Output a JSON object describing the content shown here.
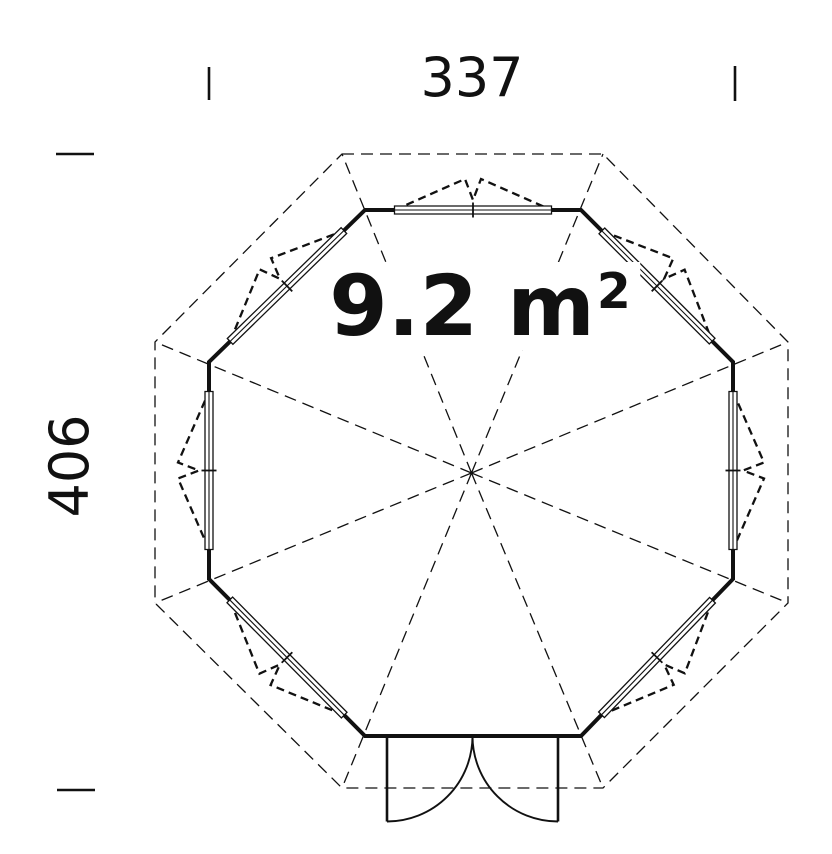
{
  "dimensions": {
    "width": "337",
    "height": "406"
  },
  "area": {
    "text": "9.2 m",
    "superscript": "2"
  },
  "plan": {
    "shape": "octagon",
    "walls": [
      {
        "side": "top",
        "feature": "window"
      },
      {
        "side": "north-east",
        "feature": "window"
      },
      {
        "side": "right",
        "feature": "window"
      },
      {
        "side": "south-east",
        "feature": "window"
      },
      {
        "side": "bottom",
        "feature": "double-door"
      },
      {
        "side": "south-west",
        "feature": "window"
      },
      {
        "side": "left",
        "feature": "window"
      },
      {
        "side": "north-west",
        "feature": "window"
      }
    ],
    "door": {
      "leaves": 2,
      "swing": "outward"
    },
    "line_color": "#111111"
  }
}
